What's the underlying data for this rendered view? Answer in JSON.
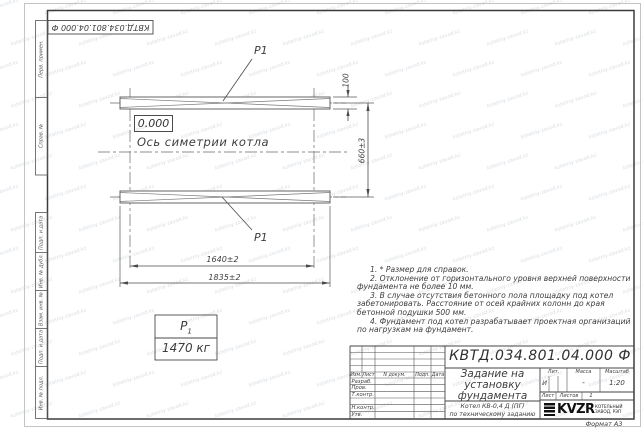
{
  "stamp_top": "КВТД.034.801.04.000 Ф",
  "watermark": {
    "text": "kotelniy-zavod.kz"
  },
  "margin": {
    "top": [
      "Перв. примен.",
      "Справ. №"
    ],
    "bottom": [
      "Подп. и дата",
      "Инв. № дубл.",
      "Взам. инв. №",
      "Подп. и дата",
      "Инв. № подл."
    ]
  },
  "drawing": {
    "p1_label": "P1",
    "elevation": "0.000",
    "axis_label": "Ось симетрии котла",
    "dims": {
      "strip_width": "100",
      "axis_spacing": "660±3",
      "bolt_spacing": "1640±2",
      "length": "1835±2"
    },
    "weight": {
      "symbol": "Р",
      "symbol_sub": "1",
      "value": "1470 кг"
    }
  },
  "notes": [
    "1. * Размер для справок.",
    "2. Отклонение от горизонтального уровня верхней поверхности фундамента не более 10 мм.",
    "3. В случае отсутствия бетонного пола площадку под котел забетонировать. Расстояние от осей крайних колонн до края бетонной подушки 500 мм.",
    "4. Фундамент под котел разрабатывает проектная организаций по нагрузкам на фундамент."
  ],
  "title_block": {
    "doc_number": "КВТД.034.801.04.000  Ф",
    "title_lines": [
      "Задание на",
      "установку",
      "фундамента"
    ],
    "subject_lines": [
      "Котел  КВ-0,4  Д  (ПГ)",
      "по техническому заданию"
    ],
    "headers": {
      "lit": "Лит.",
      "mass": "Масса",
      "scale": "Масштаб"
    },
    "values": {
      "lit": "И",
      "mass": "-",
      "scale": "1:20"
    },
    "sheet_row": {
      "list": "Лист",
      "listov": "Листов",
      "listov_value": "1"
    },
    "columns": [
      "Изм.",
      "Лист",
      "N докум.",
      "Подп.",
      "Дата"
    ],
    "sign_rows": [
      "Разраб.",
      "Пров.",
      "Т.контр.",
      "Н.контр.",
      "Утв."
    ],
    "logo": {
      "text": "KVZR",
      "caption_lines": [
        "КОТЕЛЬНЫЙ",
        "ЗАВОД, РЭП"
      ]
    },
    "format": "Формат А3"
  }
}
